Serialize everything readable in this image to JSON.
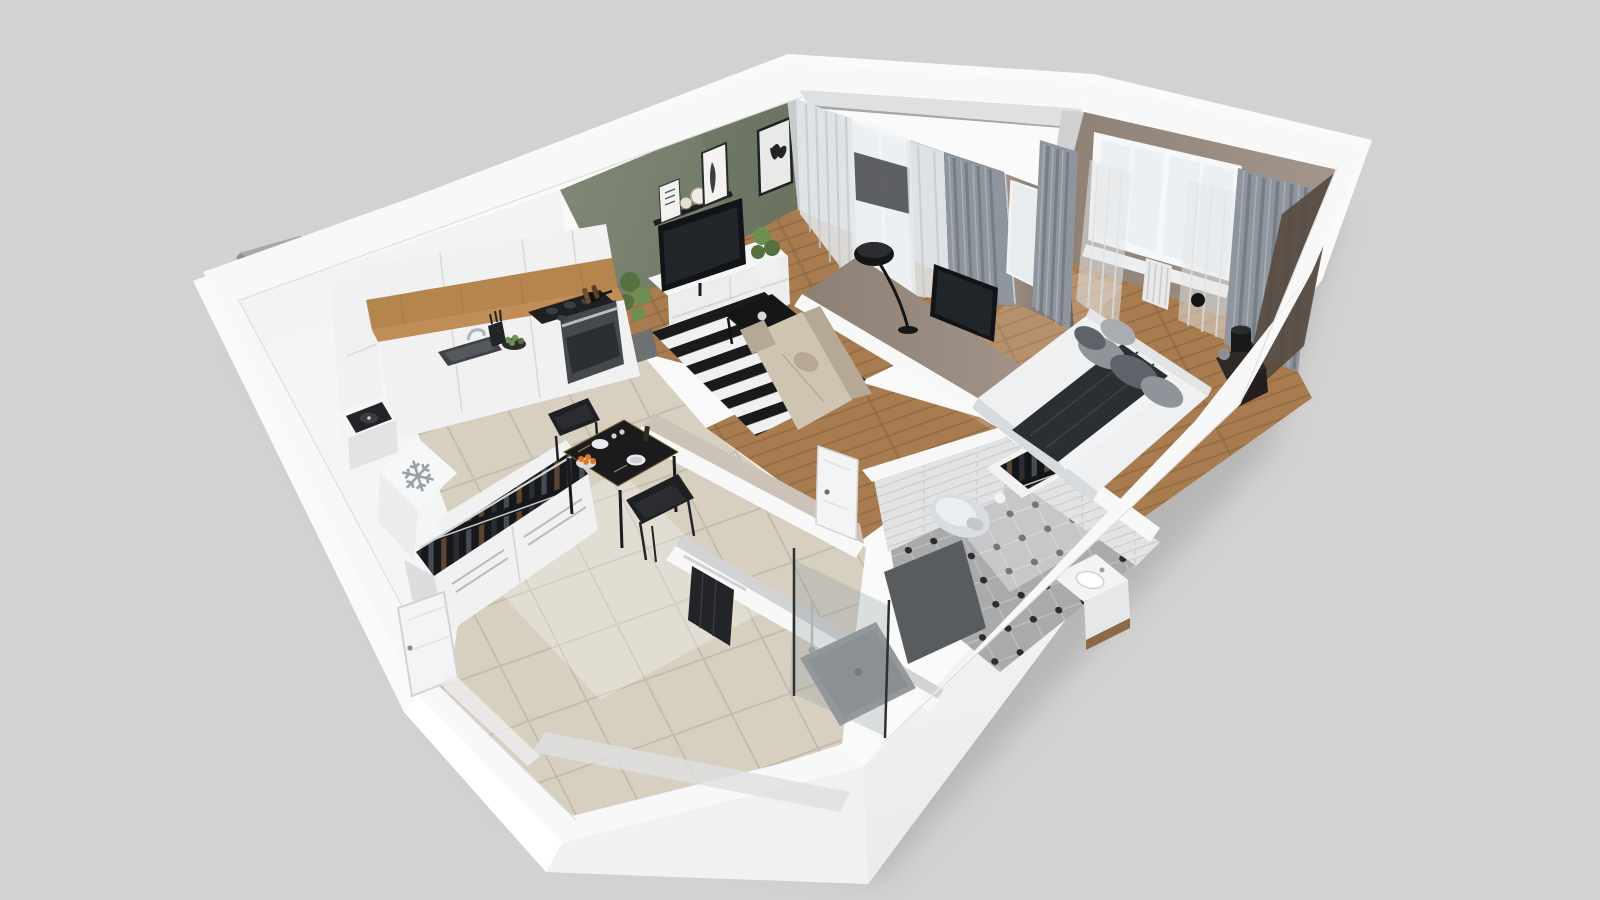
{
  "meta": {
    "kind": "isometric-3d-floorplan-render",
    "description": "Cutaway 3D render of a one-bedroom apartment viewed from above",
    "background": "#d2d2d2"
  },
  "icons": {
    "snowflake_glyph": "❄"
  },
  "palette": {
    "bg": "#d2d2d2",
    "white": "#fafafa",
    "band": "#f8f8f9",
    "faceLight": "#f3f3f4",
    "faceDim": "#e9e9ea",
    "innerGray": "#dddddd",
    "innerShade": "#c9c9cb",
    "olive": "#7b8471",
    "oliveDark": "#68715e",
    "taupe": "#95867a",
    "taupeDark": "#6f6156",
    "taupeDeep": "#55493f",
    "wood": "#a97c4f",
    "woodDark": "#7d5a39",
    "tile": "#d7d0c1",
    "tileLine": "#c2b9a9",
    "bathLight": "#e7e6e4",
    "bathShade": "#a9aaac",
    "bathDot": "#2d2d2f",
    "subway": "#e1e2e4",
    "subwayLine": "#c8c9cb",
    "subwayShade": "#d2d3d5",
    "cab": "#f1f1f2",
    "cabShade": "#e2e3e5",
    "seam": "#c6c7c9",
    "counter": "#bf8d55",
    "woodPanel": "#b5854e",
    "dark": "#1b1c1e",
    "steel": "#9aa0a4",
    "oven": "#45484c",
    "glass": "#edf0f2",
    "frame": "#f6f7f8",
    "curtain": "#8e959c",
    "curtainDark": "#767d85",
    "sheer": "#e3e6e8",
    "balconyFloor": "#a4a7aa",
    "rail": "#2c2f32",
    "rugW": "#f0f0f0",
    "rugB": "#1a1a1c",
    "sofa": "#cfc3b1",
    "sofaShade": "#b5a894",
    "green": "#567040",
    "greenLight": "#6f8f52",
    "pot": "#5d6165",
    "bedW": "#eef0f2",
    "bedShade": "#d8dbde",
    "blanket": "#2b2e33",
    "pillow": "#8f949a",
    "pillowDark": "#5e636a",
    "tv": "#121316",
    "screen": "#21262b",
    "stand": "#f4f5f6",
    "toilet": "#d9dde0",
    "towel": "#232427",
    "door": "#f3f4f5",
    "panelDark": "#595c5f",
    "shelfWood": "#8c6a45",
    "orange": "#e0761f",
    "plate": "#e9e9eb",
    "lampBall": "#8d9195",
    "clothesA": "#5a4632",
    "clothesB": "#2b2d33",
    "clothesC": "#474b55"
  },
  "rooms": [
    {
      "id": "living-kitchen",
      "floor": "wood-and-tile",
      "accent_wall_color": "#7b8471"
    },
    {
      "id": "bedroom",
      "floor": "wood"
    },
    {
      "id": "bathroom",
      "floor": "octagon-tile"
    },
    {
      "id": "hallway",
      "floor": "tile"
    },
    {
      "id": "balcony",
      "floor": "concrete"
    }
  ],
  "objects": [
    "kitchen-cabinets",
    "cooktop",
    "oven",
    "sink",
    "fruit-bowl",
    "knife-block",
    "fridge",
    "record-player",
    "open-wardrobe-hall",
    "dining-table",
    "dining-chairs",
    "tv-stand",
    "television",
    "wall-shelf",
    "picture-frames",
    "potted-plants",
    "striped-rug",
    "coffee-table",
    "sofa",
    "floor-lamp",
    "balcony-door",
    "balcony-railing",
    "curtains",
    "bed",
    "pillows",
    "nightstand",
    "table-lamp",
    "bedroom-wall-tv",
    "open-wardrobe-bedroom",
    "bedroom-window",
    "radiator",
    "toilet",
    "toilet-paper",
    "shower",
    "shower-glass",
    "vanity-sink",
    "black-towel",
    "entrance-door",
    "interior-door",
    "ventilation-shaft"
  ]
}
